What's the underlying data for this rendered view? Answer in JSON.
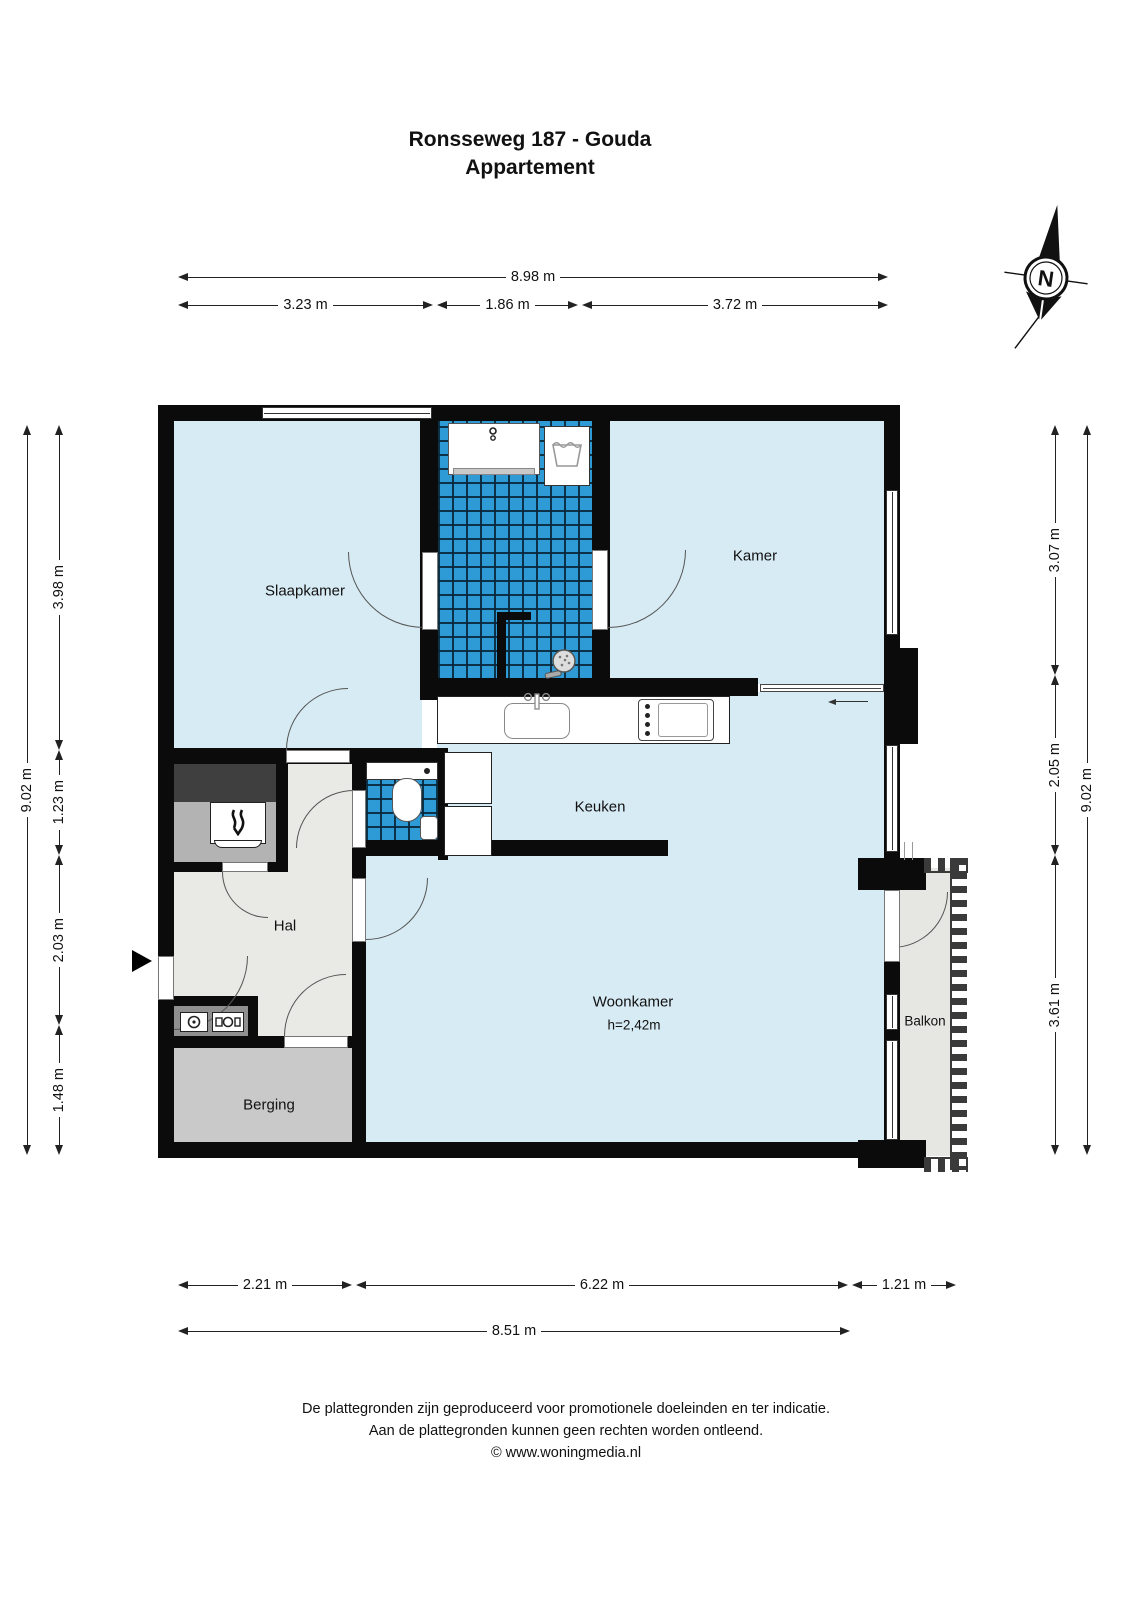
{
  "title": {
    "line1": "Ronsseweg 187 - Gouda",
    "line2": "Appartement"
  },
  "compass": {
    "label": "N"
  },
  "rooms": {
    "slaapkamer": "Slaapkamer",
    "kamer": "Kamer",
    "keuken": "Keuken",
    "hal": "Hal",
    "woonkamer": "Woonkamer",
    "woonkamer_height": "h=2,42m",
    "berging": "Berging",
    "balkon": "Balkon"
  },
  "dimensions": {
    "top": {
      "overall": "8.98 m",
      "segments": [
        "3.23 m",
        "1.86 m",
        "3.72 m"
      ]
    },
    "bottom": {
      "segments": [
        "2.21 m",
        "6.22 m",
        "1.21 m"
      ],
      "overall": "8.51 m"
    },
    "left": {
      "overall": "9.02 m",
      "segments": [
        "3.98 m",
        "1.23 m",
        "2.03 m",
        "1.48 m"
      ]
    },
    "right": {
      "segments": [
        "3.07 m",
        "2.05 m",
        "3.61 m"
      ],
      "overall": "9.02 m"
    }
  },
  "footer": {
    "line1": "De plattegronden zijn geproduceerd voor promotionele doeleinden en ter indicatie.",
    "line2": "Aan de plattegronden kunnen geen rechten worden ontleend.",
    "line3": "© www.woningmedia.nl"
  },
  "colors": {
    "wall": "#0b0b0b",
    "room_floor": "#d7ebf4",
    "tile_blue": "#2e9bd6",
    "hal_floor": "#e9e9e5",
    "berging_floor": "#c9c9c9",
    "balkon_floor": "#e6e6e3",
    "cupboard": "#8f8f8f",
    "closet_dark": "#3f3f3f",
    "closet_light": "#b3b3b3"
  }
}
